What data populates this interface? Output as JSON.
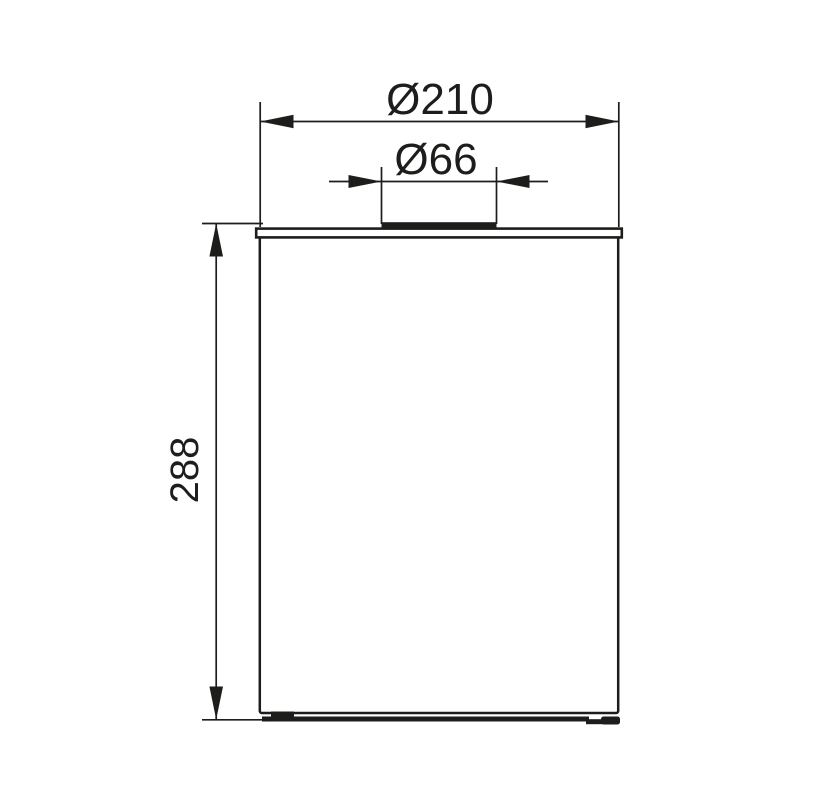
{
  "drawing": {
    "labels": {
      "outer_diameter": "Ø210",
      "opening_diameter": "Ø66",
      "height": "288"
    },
    "colors": {
      "ink": "#1d1d1b",
      "paper": "#ffffff"
    }
  }
}
